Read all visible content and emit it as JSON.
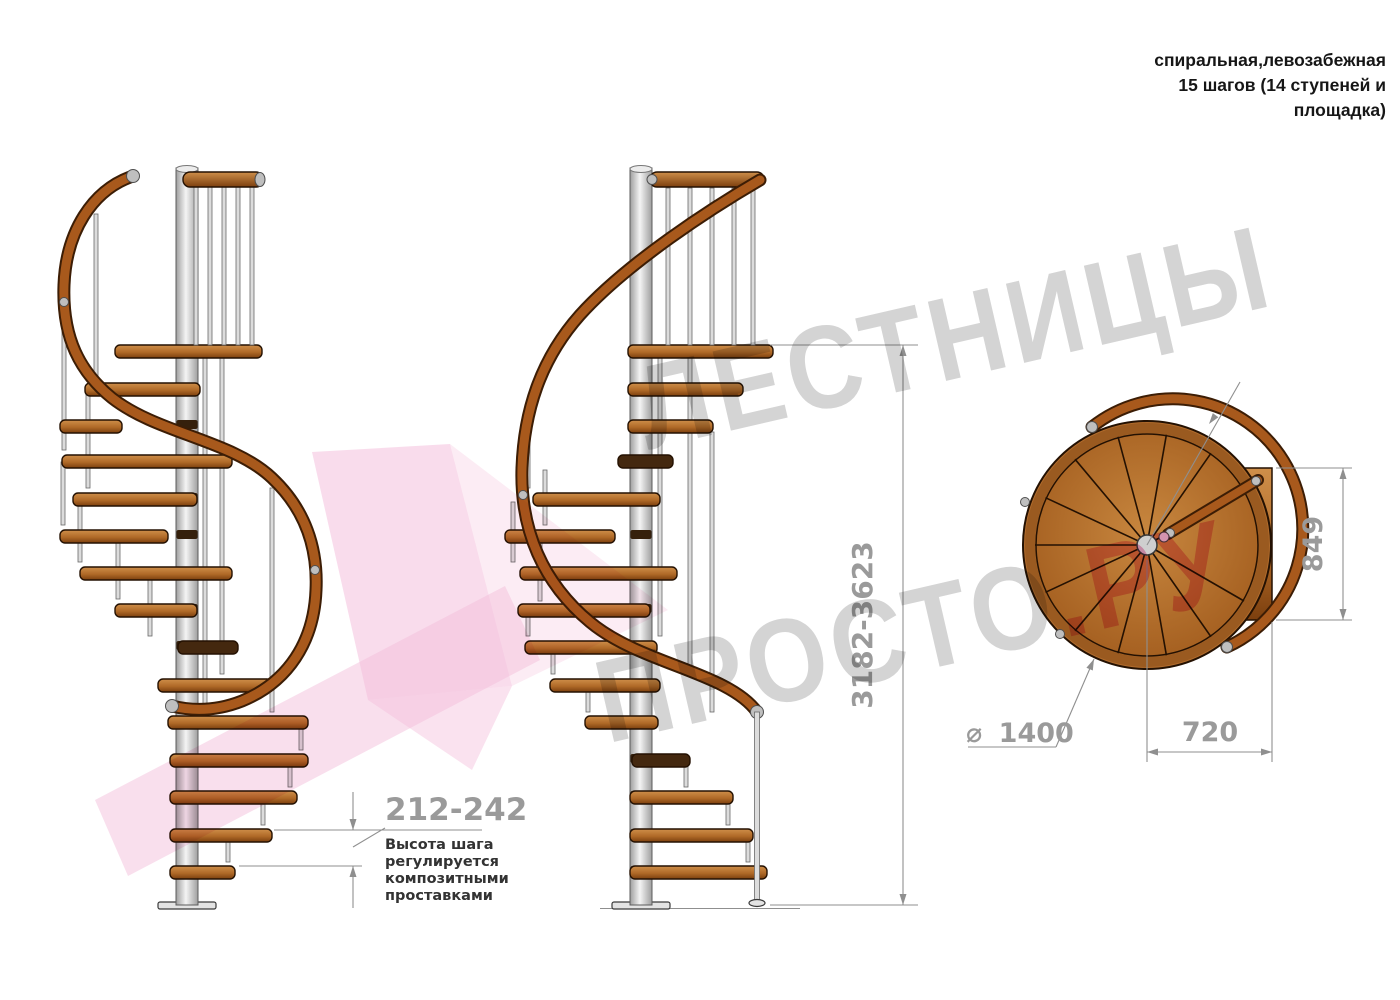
{
  "annotation": {
    "line1": "спиральная,левозабежная",
    "line2": "15 шагов (14 ступеней и",
    "line3": "площадка)"
  },
  "watermark": {
    "line1": "ЛЕСТНИЦЫ",
    "line2_gray": "ПРОСТО",
    "line2_pink": ".РУ"
  },
  "dimensions": {
    "step_height": "212-242",
    "total_height": "3182-3623",
    "landing_depth": "849",
    "landing_width": "720",
    "diameter_symbol": "⌀",
    "diameter_value": "1400"
  },
  "note": {
    "line1": "Высота шага",
    "line2": "регулируется",
    "line3": "композитными",
    "line4": "проставками"
  },
  "colors": {
    "wood_light": "#cf8f4a",
    "wood_mid": "#b06a28",
    "wood_dark": "#7c3f0e",
    "rail": "#a8591c",
    "rail_dark": "#3c1d05",
    "outline": "#241102",
    "steel_light": "#f4f4f4",
    "steel_mid": "#d7d7d7",
    "steel_dark": "#9e9e9e",
    "dim_line": "#8f8f8f",
    "dim_text": "#9a9a9a",
    "note_text": "#333333",
    "wm_gray": "#d4d4d4",
    "wm_pink": "#f2a8c8",
    "pink_shape": "#f4bfdc"
  }
}
